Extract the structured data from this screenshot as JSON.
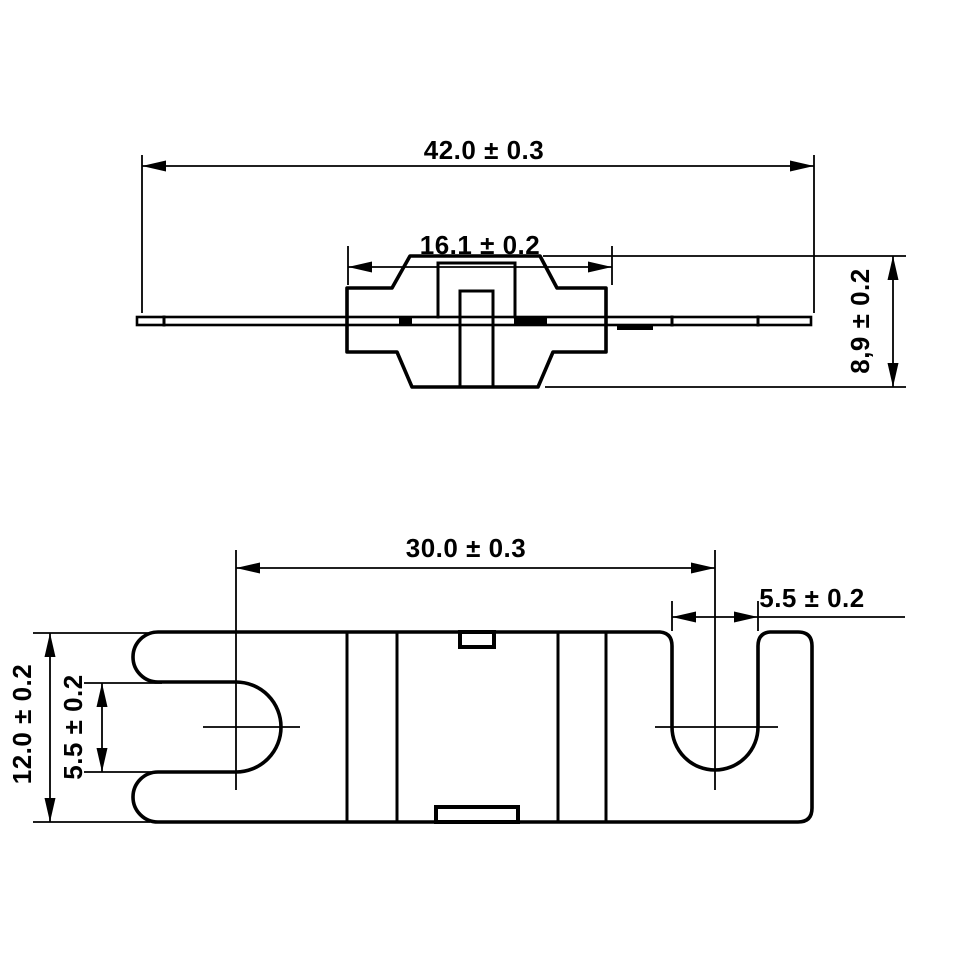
{
  "drawing": {
    "background_color": "#ffffff",
    "line_color": "#000000",
    "views": [
      "side-view",
      "plan-view"
    ]
  },
  "dimensions": {
    "side_view": {
      "overall_width": "42.0 ± 0.3",
      "cap_width": "16.1 ± 0.2",
      "height": "8,9 ± 0.2"
    },
    "plan_view": {
      "slot_center_spacing": "30.0 ± 0.3",
      "right_slot_width": "5.5 ± 0.2",
      "left_slot_width": "5.5 ± 0.2",
      "plate_width": "12.0 ± 0.2"
    }
  }
}
